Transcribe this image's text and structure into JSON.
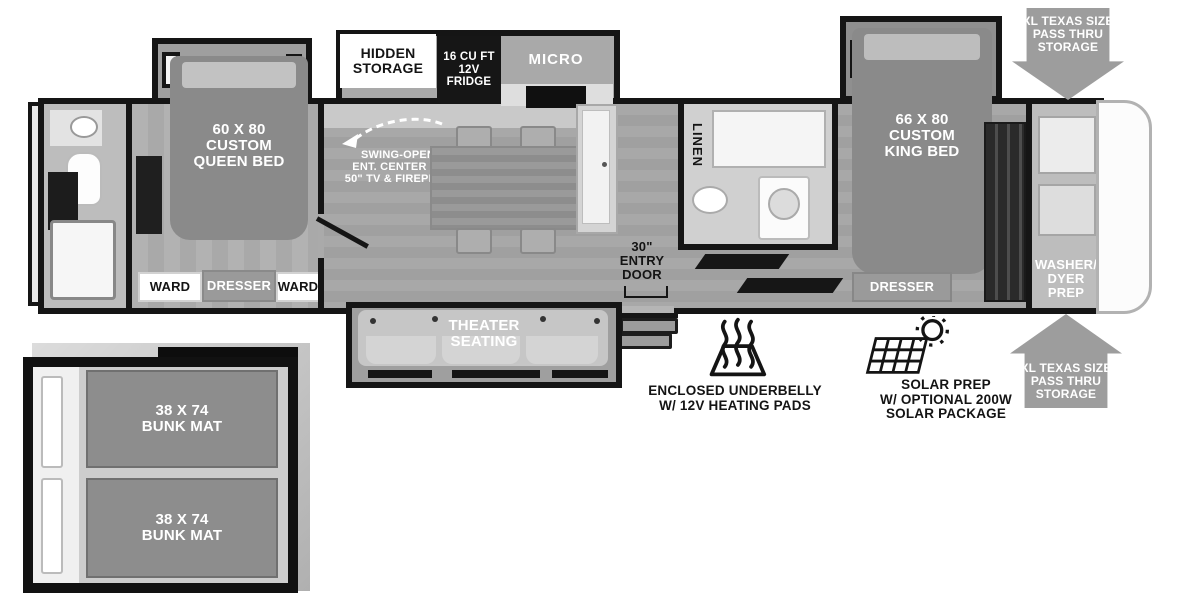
{
  "diagram_type": "rv-floorplan",
  "colors": {
    "wall": "#151515",
    "floor": "#a6a6a6",
    "bed": "#8a8a8a",
    "counter": "#c9c9c9",
    "fridge": "#161616",
    "arrow_gray": "#9d9d9d",
    "label_box_white": "#ffffff",
    "dresser_gray": "#9a9a9a",
    "text_white": "#ffffff",
    "text_black": "#141414"
  },
  "icons": {
    "heat": "heat-waves-icon",
    "solar": "solar-panel-sun-icon",
    "arrow_down": "pass-thru-arrow-down-icon",
    "arrow_up": "pass-thru-arrow-up-icon",
    "swing_arrow": "dashed-swing-arrow-icon"
  },
  "labels": {
    "hidden_storage": [
      "HIDDEN",
      "STORAGE"
    ],
    "fridge": [
      "16 CU FT",
      "12V",
      "FRIDGE"
    ],
    "micro": "MICRO",
    "queen_bed": [
      "60 X 80",
      "CUSTOM",
      "QUEEN BED"
    ],
    "swing_open": [
      "SWING-OPEN",
      "ENT. CENTER W/",
      "50\" TV & FIREPLCE"
    ],
    "ward_left": "WARD",
    "dresser_bed1": "DRESSER",
    "ward_right": "WARD",
    "theater": [
      "THEATER",
      "SEATING"
    ],
    "entry_door": [
      "30\"",
      "ENTRY",
      "DOOR"
    ],
    "linen": "LINEN",
    "king_bed": [
      "66 X 80",
      "CUSTOM",
      "KING BED"
    ],
    "dresser_bed2": "DRESSER",
    "washer_prep": [
      "WASHER/",
      "DYER",
      "PREP"
    ],
    "pass_thru_top": [
      "XL TEXAS SIZE",
      "PASS THRU",
      "STORAGE"
    ],
    "pass_thru_bottom": [
      "XL TEXAS SIZE",
      "PASS THRU",
      "STORAGE"
    ],
    "underbelly": [
      "ENCLOSED UNDERBELLY",
      "W/ 12V HEATING PADS"
    ],
    "solar": [
      "SOLAR PREP",
      "W/ OPTIONAL 200W",
      "SOLAR PACKAGE"
    ],
    "bunk_top": [
      "38 X 74",
      "BUNK MAT"
    ],
    "bunk_bottom": [
      "38 X 74",
      "BUNK MAT"
    ]
  }
}
